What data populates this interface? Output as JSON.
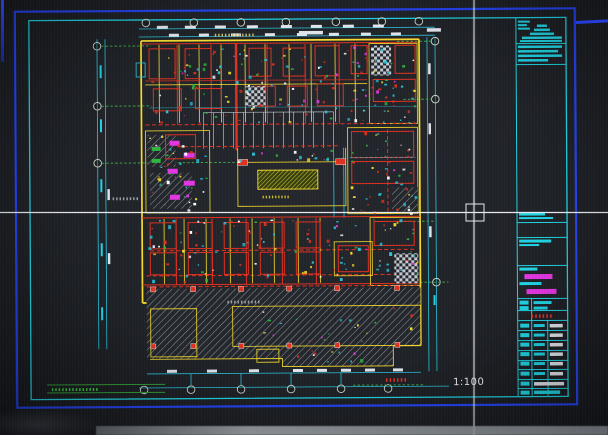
{
  "app": {
    "view": "CAD drawing viewport",
    "content": "architectural floor plan (photographed screen)"
  },
  "drawing": {
    "scale_label": "1:100",
    "top_title_text": "▮▮▮▮▮▮▮▮▮▮▮▮",
    "courtyard_label": "▮▮▮▮▮▮▮▮▮",
    "hall_label": "▮▮▮▮▮▮▮▮▮▮",
    "left_margin_note": "▮▮▮▮▮▮▮▮",
    "bottom_left_note": "▮▮▮▮▮▮▮▮▮▮▮▮▮▮",
    "bottom_red_stamp": "▮▮▮▮▮▮"
  },
  "title_block": {
    "red_line": "▮▮▮▮▮▮"
  },
  "colors": {
    "frame_blue": "#2543f0",
    "frame_cyan": "#20d2e2",
    "wall_red": "#e03020",
    "wall_yellow": "#f5d92c",
    "fixture_green": "#2cb83c",
    "fixture_magenta": "#e236e2",
    "dim_cyan": "#2ac4dc",
    "hatch_gray": "#8d939d",
    "hatch_yellow": "#d8c400",
    "crosshair": "#e6eaf0",
    "note_green": "#36cf3c",
    "stamp_red": "#e63226",
    "dim_text_white": "#dfe4ea"
  }
}
